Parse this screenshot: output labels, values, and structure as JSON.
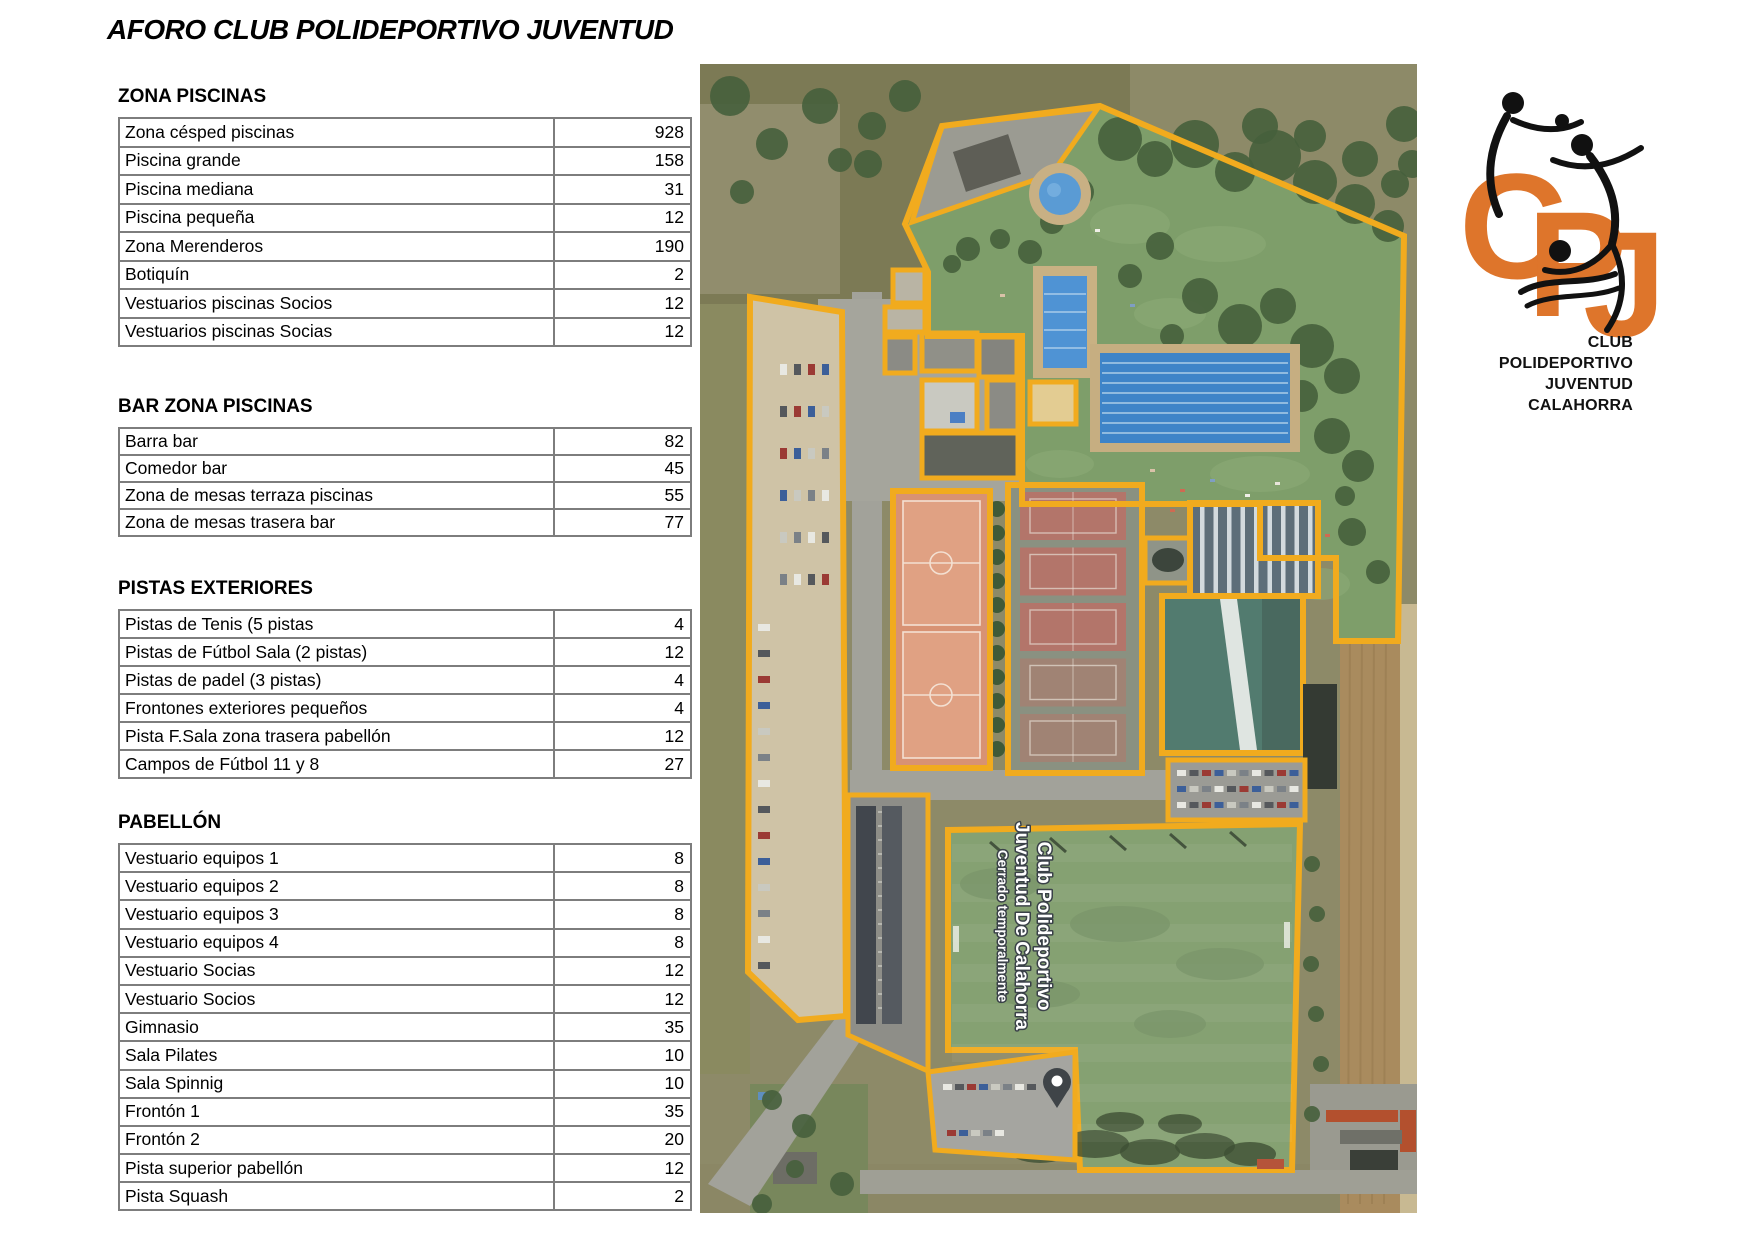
{
  "title": "AFORO CLUB POLIDEPORTIVO JUVENTUD",
  "sections": [
    {
      "heading": "ZONA PISCINAS",
      "rows": [
        {
          "label": "Zona césped piscinas",
          "value": "928"
        },
        {
          "label": "Piscina grande",
          "value": "158"
        },
        {
          "label": "Piscina mediana",
          "value": "31"
        },
        {
          "label": "Piscina pequeña",
          "value": "12"
        },
        {
          "label": "Zona Merenderos",
          "value": "190"
        },
        {
          "label": "Botiquín",
          "value": "2"
        },
        {
          "label": "Vestuarios piscinas Socios",
          "value": "12"
        },
        {
          "label": "Vestuarios piscinas Socias",
          "value": "12"
        }
      ]
    },
    {
      "heading": "BAR ZONA PISCINAS",
      "rows": [
        {
          "label": "Barra bar",
          "value": "82"
        },
        {
          "label": "Comedor bar",
          "value": "45"
        },
        {
          "label": "Zona de mesas terraza piscinas",
          "value": "55"
        },
        {
          "label": "Zona de mesas trasera bar",
          "value": "77"
        }
      ]
    },
    {
      "heading": "PISTAS EXTERIORES",
      "rows": [
        {
          "label": "Pistas de Tenis (5 pistas",
          "value": "4"
        },
        {
          "label": "Pistas de Fútbol Sala (2 pistas)",
          "value": "12"
        },
        {
          "label": "Pistas de padel (3 pistas)",
          "value": "4"
        },
        {
          "label": "Frontones exteriores pequeños",
          "value": "4"
        },
        {
          "label": "Pista F.Sala zona trasera pabellón",
          "value": "12"
        },
        {
          "label": "Campos de Fútbol 11 y 8",
          "value": "27"
        }
      ]
    },
    {
      "heading": "PABELLÓN",
      "rows": [
        {
          "label": "Vestuario equipos 1",
          "value": "8"
        },
        {
          "label": "Vestuario equipos 2",
          "value": "8"
        },
        {
          "label": "Vestuario equipos 3",
          "value": "8"
        },
        {
          "label": "Vestuario equipos 4",
          "value": "8"
        },
        {
          "label": "Vestuario Socias",
          "value": "12"
        },
        {
          "label": "Vestuario Socios",
          "value": "12"
        },
        {
          "label": "Gimnasio",
          "value": "35"
        },
        {
          "label": "Sala Pilates",
          "value": "10"
        },
        {
          "label": "Sala Spinnig",
          "value": "10"
        },
        {
          "label": "Frontón 1",
          "value": "35"
        },
        {
          "label": "Frontón 2",
          "value": "20"
        },
        {
          "label": "Pista superior pabellón",
          "value": "12"
        },
        {
          "label": "Pista Squash",
          "value": "2"
        }
      ]
    }
  ],
  "map": {
    "label_line1": "Club Polideportivo",
    "label_line2": "Juventud De Calahorra",
    "label_line3": "Cerrado temporalmente",
    "outline_color": "#F1AB1E"
  },
  "logo": {
    "letters": {
      "c": "C",
      "p": "P",
      "j": "J"
    },
    "line1": "CLUB POLIDEPORTIVO",
    "line2": "JUVENTUD",
    "line3": "CALAHORRA",
    "orange": "#DE752B"
  }
}
